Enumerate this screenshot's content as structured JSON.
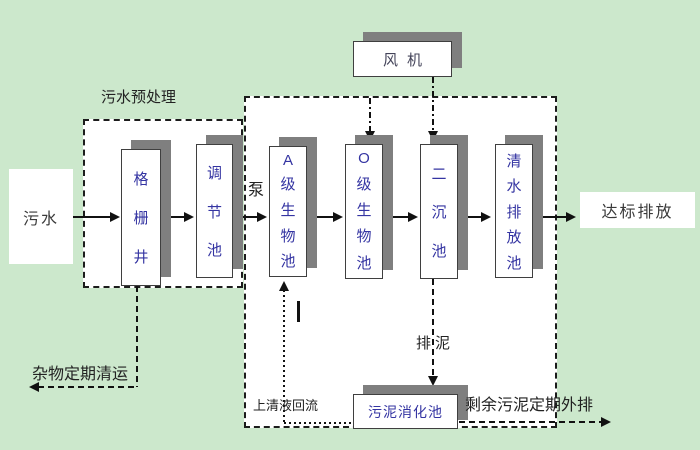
{
  "colors": {
    "background": "#cce8cc",
    "box_fill": "#ffffff",
    "box_shadow": "#7f7f7f",
    "unit_text": "#3434a2",
    "label_text": "#222222",
    "line": "#111111"
  },
  "diagram": {
    "source": "污水",
    "discharge": "达标排放",
    "pump_label": "泵",
    "fan_label": "风机",
    "pretreatment": {
      "title": "污水预处理",
      "grid_well": "格栅井",
      "regulating_tank": "调节池"
    },
    "process_units": {
      "tank_a": "A级生物池",
      "tank_o": "O级生物池",
      "secondary_sedimentation": "二沉池",
      "clear_water_discharge": "清水排放池"
    },
    "sludge": {
      "digestion_tank": "污泥消化池",
      "discharge_label": "排泥",
      "supernatant_return": "上清液回流",
      "excess_out": "剩余污泥定期外排"
    },
    "debris_removal": "杂物定期清运"
  }
}
